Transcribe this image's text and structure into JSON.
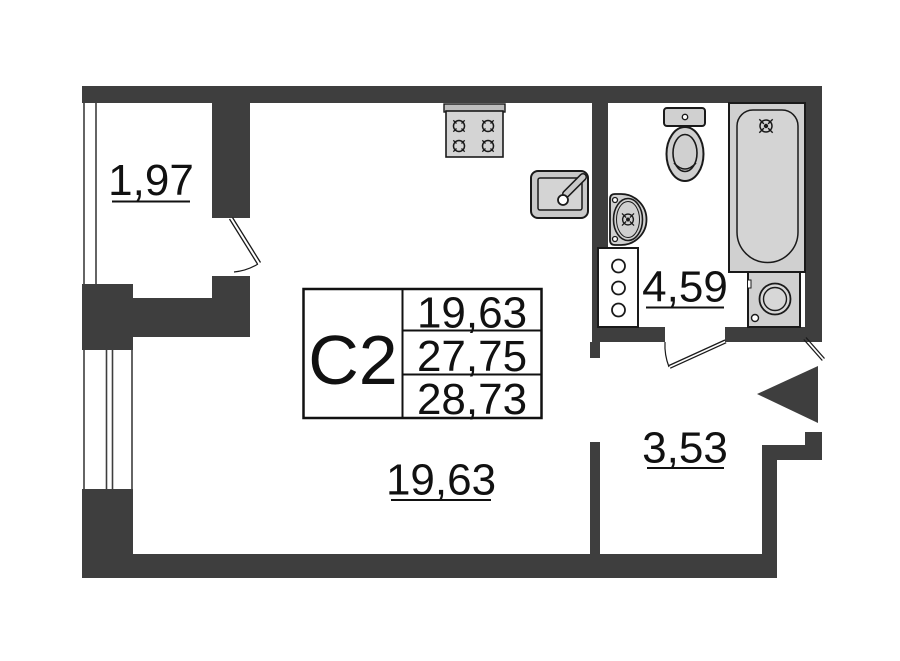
{
  "unit_card": {
    "unit_label": "С2",
    "area_rows": [
      "19,63",
      "27,75",
      "28,73"
    ]
  },
  "rooms": {
    "balcony": {
      "area_label": "1,97"
    },
    "living_room": {
      "area_label": "19,63"
    },
    "bathroom": {
      "area_label": "4,59"
    },
    "hallway": {
      "area_label": "3,53"
    }
  },
  "icons": [
    "stove-icon",
    "kitchen-sink-icon",
    "toilet-icon",
    "washbasin-icon",
    "bathtub-icon",
    "washing-machine-icon",
    "utility-shaft-icon",
    "entrance-arrow-icon",
    "faucet-crosshair-icon"
  ],
  "colors": {
    "wall": "#3e3e3e",
    "outline": "#1a1a1a",
    "fixture_fill": "#d0d0d0",
    "background": "#ffffff",
    "text": "#111111"
  }
}
